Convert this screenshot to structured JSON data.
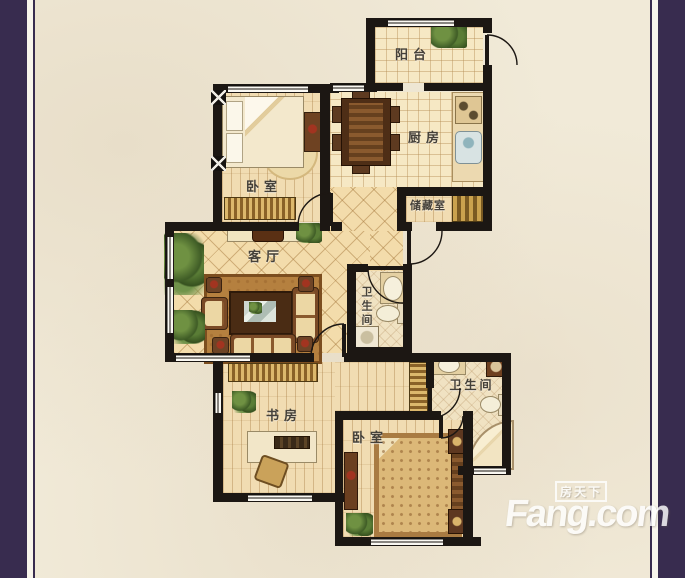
{
  "colors": {
    "purple": "#382c4f",
    "cream": "#f1ead8",
    "wall": "#1c1713",
    "plank": "#f1dcb2",
    "tile": "#f6e8c4",
    "diamond": "#f3dcab",
    "bath": "#f0e2c2",
    "red": "#a23420",
    "wm": "#ffffff"
  },
  "rooms": {
    "balcony": {
      "label": "阳台"
    },
    "kitchen": {
      "label": "厨房"
    },
    "bedroom_top": {
      "label": "卧室"
    },
    "storage": {
      "label": "储藏室"
    },
    "living_room": {
      "label": "客厅"
    },
    "bathroom_middle": {
      "label": "卫生间"
    },
    "study": {
      "label": "书房"
    },
    "bedroom_bottom": {
      "label": "卧室"
    },
    "bathroom_bottom": {
      "label": "卫生间"
    }
  },
  "watermark": {
    "brand": "Fang.com",
    "tagline": "房天下"
  }
}
